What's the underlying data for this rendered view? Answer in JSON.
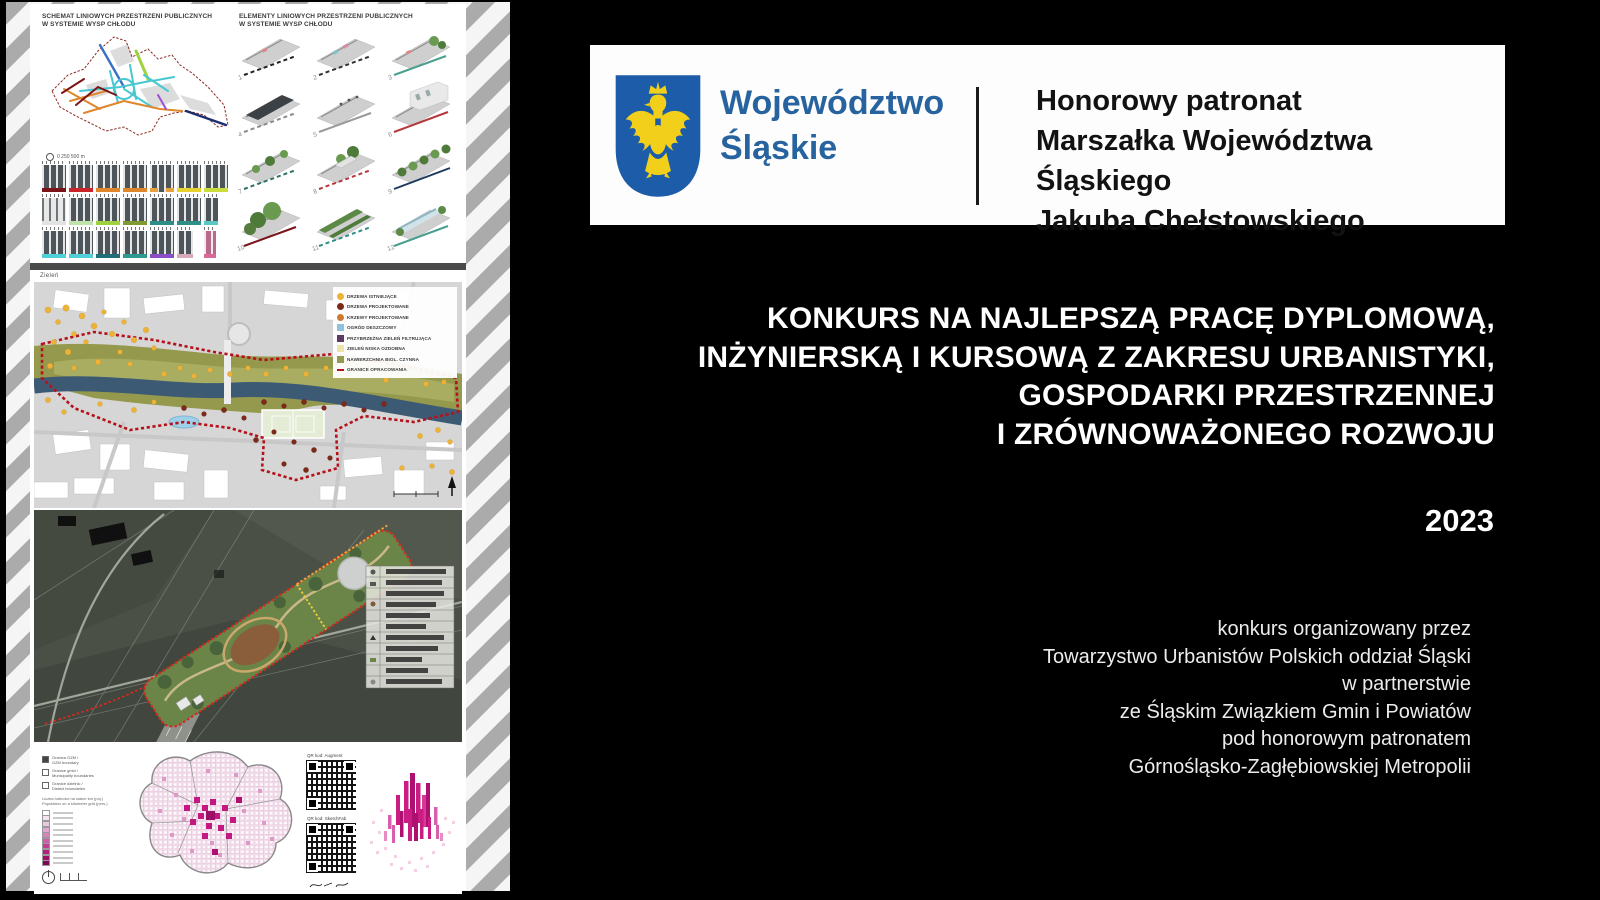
{
  "banner": {
    "region_line1": "Województwo",
    "region_line2": "Śląskie",
    "patronage_line1": "Honorowy patronat",
    "patronage_line2": "Marszałka Województwa Śląskiego",
    "patronage_line3": "Jakuba Chełstowskiego"
  },
  "main": {
    "title_line1": "KONKURS NA NAJLEPSZĄ PRACĘ DYPLOMOWĄ,",
    "title_line2": "INŻYNIERSKĄ   I  KURSOWĄ Z ZAKRESU URBANISTYKI,",
    "title_line3": "GOSPODARKI PRZESTRZENNEJ",
    "title_line4": "I ZRÓWNOWAŻONEGO ROZWOJU",
    "year": "2023",
    "credits_line1": "konkurs organizowany przez",
    "credits_line2": "Towarzystwo Urbanistów Polskich oddział Śląski",
    "credits_line3": "w partnerstwie",
    "credits_line4": "ze Śląskim Związkiem Gmin i Powiatów",
    "credits_line5": "pod honorowym patronatem",
    "credits_line6": "Górnośląsko-Zagłębiowskiej Metropolii"
  },
  "posters": {
    "schemat": {
      "header_left": "SCHEMAT LINIOWYCH PRZESTRZENI PUBLICZNYCH\nW SYSTEMIE WYSP CHŁODU",
      "header_right": "ELEMENTY LINIOWYCH PRZESTRZENI PUBLICZNYCH\nW SYSTEMIE WYSP CHŁODU",
      "scale_text": "0     250    500 m",
      "item_numbers": [
        "1",
        "2",
        "3",
        "4",
        "5",
        "6",
        "7",
        "8",
        "9",
        "10",
        "11",
        "12"
      ]
    },
    "zielen": {
      "label": "Zieleń",
      "legend": [
        {
          "label": "DRZEWA ISTNIEJĄCE"
        },
        {
          "label": "DRZEWA PROJEKTOWANE"
        },
        {
          "label": "KRZEWY PROJEKTOWANE"
        },
        {
          "label": "OGRÓD DESZCZOWY"
        },
        {
          "label": "PRZYBRZEŻNA ZIELEŃ FILTRUJĄCA"
        },
        {
          "label": "ZIELEŃ NISKA OZDOBNA"
        },
        {
          "label": "NAWIERZCHNIA BIOL. CZYNNA"
        },
        {
          "label": "GRANICE OPRACOWANIA"
        }
      ]
    },
    "gestosc": {
      "boundary1_pl": "Granica GZM /",
      "boundary1_en": "GZM boundary",
      "boundary2_pl": "Granice gmin /",
      "boundary2_en": "Municipality boundaries",
      "boundary3_pl": "Granice dzielnic /",
      "boundary3_en": "District boundaries",
      "note_pl": "Liczba ludności na siatce km (poj.)",
      "note_en": "Population on a kilometer grid (pers.)",
      "qr1_label": "QR kod: Augment",
      "qr2_label": "QR kod: SketchFab"
    }
  },
  "colors": {
    "accent_blue": "#27639f",
    "shield_blue": "#1c5ca8",
    "eagle_gold": "#f2cf1b",
    "boundary_red": "#b5121b",
    "magenta": "#c91d84"
  }
}
